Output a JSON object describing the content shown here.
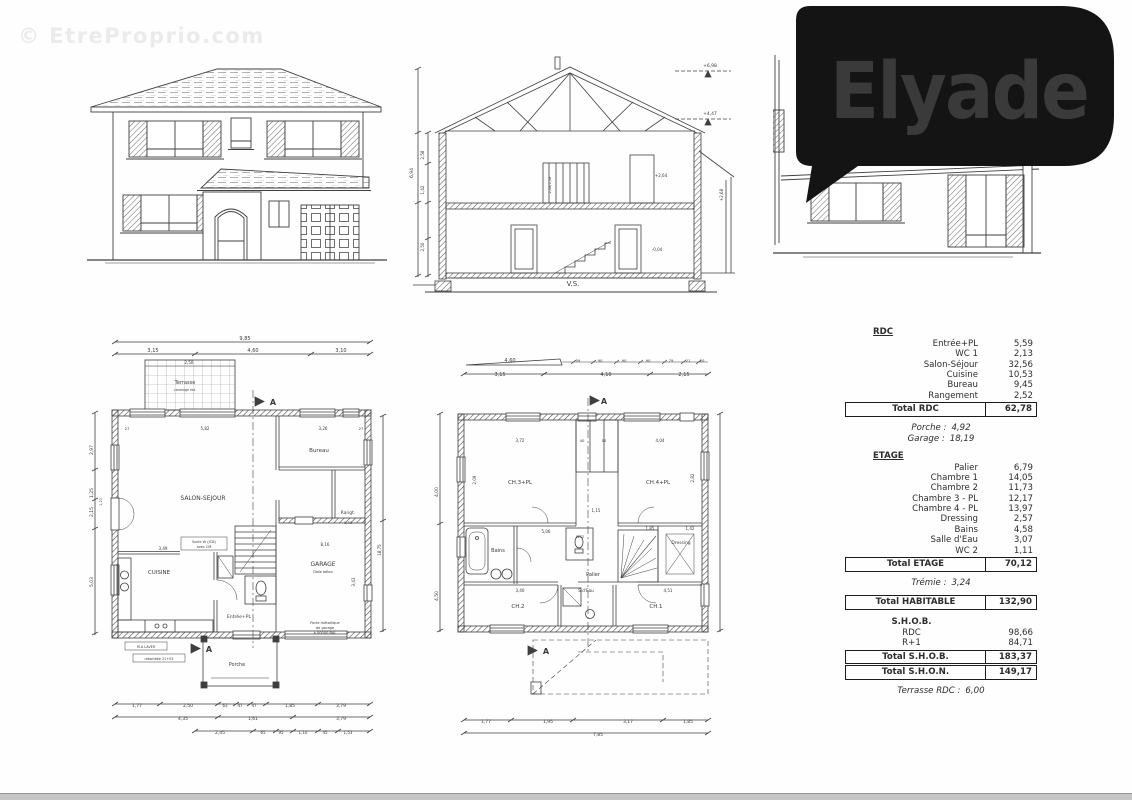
{
  "watermark": {
    "text": "© EtreProprio.com"
  },
  "logo": {
    "text": "Elyade",
    "bg": "#141414",
    "text_color": "#ffffff",
    "underline_from": "#ee1283",
    "underline_to": "#7d2f94"
  },
  "area_table": {
    "rows": [
      {
        "label": "RDC",
        "value": "",
        "style": "header"
      },
      {
        "label": "Entrée+PL",
        "value": "5,59"
      },
      {
        "label": "WC 1",
        "value": "2,13"
      },
      {
        "label": "Salon-Séjour",
        "value": "32,56"
      },
      {
        "label": "Cuisine",
        "value": "10,53"
      },
      {
        "label": "Bureau",
        "value": "9,45"
      },
      {
        "label": "Rangement",
        "value": "2,52"
      },
      {
        "label": "Total RDC",
        "value": "62,78",
        "style": "total"
      },
      {
        "style": "spacer"
      },
      {
        "label": "Porche :",
        "value": "4,92",
        "style": "italic"
      },
      {
        "label": "Garage :",
        "value": "18,19",
        "style": "italic"
      },
      {
        "style": "spacer"
      },
      {
        "label": "ETAGE",
        "value": "",
        "style": "header"
      },
      {
        "label": "Palier",
        "value": "6,79"
      },
      {
        "label": "Chambre 1",
        "value": "14,05"
      },
      {
        "label": "Chambre 2",
        "value": "11,73"
      },
      {
        "label": "Chambre 3 - PL",
        "value": "12,17"
      },
      {
        "label": "Chambre 4 - PL",
        "value": "13,97"
      },
      {
        "label": "Dressing",
        "value": "2,57"
      },
      {
        "label": "Bains",
        "value": "4,58"
      },
      {
        "label": "Salle d'Eau",
        "value": "3,07"
      },
      {
        "label": "WC 2",
        "value": "1,11"
      },
      {
        "label": "Total ETAGE",
        "value": "70,12",
        "style": "total"
      },
      {
        "style": "spacer"
      },
      {
        "label": "Trémie :",
        "value": "3,24",
        "style": "italic"
      },
      {
        "style": "spacer"
      },
      {
        "label": "Total HABITABLE",
        "value": "132,90",
        "style": "total"
      },
      {
        "style": "spacer"
      },
      {
        "label": "S.H.O.B.",
        "value": "",
        "style": "plainhead"
      },
      {
        "label": "RDC",
        "value": "98,66",
        "style": "center"
      },
      {
        "label": "R+1",
        "value": "84,71",
        "style": "center"
      },
      {
        "label": "Total S.H.O.B.",
        "value": "183,37",
        "style": "total"
      },
      {
        "label": "Total S.H.O.N.",
        "value": "149,17",
        "style": "total"
      },
      {
        "style": "spacer"
      },
      {
        "label": "Terrasse RDC :",
        "value": "6,00",
        "style": "italic"
      }
    ]
  },
  "drawings": {
    "section": {
      "labels": [
        {
          "t": "V.S.",
          "x": 168,
          "y": 231,
          "fs": 7
        },
        {
          "t": "+6,98",
          "x": 305,
          "y": 12,
          "fs": 4.5
        },
        {
          "t": "+4,47",
          "x": 305,
          "y": 60,
          "fs": 4.5
        },
        {
          "t": "+2,64",
          "x": 256,
          "y": 122,
          "fs": 4
        },
        {
          "t": "-0,04",
          "x": 252,
          "y": 196,
          "fs": 4
        },
        {
          "t": "+2,68",
          "x": 318,
          "y": 140,
          "fs": 4,
          "rot": 1
        },
        {
          "t": "6,94",
          "x": 8,
          "y": 118,
          "fs": 4.5,
          "rot": 1
        },
        {
          "t": "2,58",
          "x": 19,
          "y": 100,
          "fs": 4,
          "rot": 1
        },
        {
          "t": "1,42",
          "x": 19,
          "y": 135,
          "fs": 4,
          "rot": 1
        },
        {
          "t": "2,50",
          "x": 19,
          "y": 192,
          "fs": 4,
          "rot": 1
        },
        {
          "t": "2,48/2,58",
          "x": 146,
          "y": 130,
          "fs": 3.5,
          "rot": 1
        }
      ]
    },
    "rdc_plan": {
      "labels": [
        {
          "t": "9,85",
          "x": 160,
          "y": 10,
          "fs": 5
        },
        {
          "t": "3,15",
          "x": 68,
          "y": 22,
          "fs": 5
        },
        {
          "t": "4,60",
          "x": 168,
          "y": 22,
          "fs": 5
        },
        {
          "t": "3,10",
          "x": 256,
          "y": 22,
          "fs": 5
        },
        {
          "t": "2,50",
          "x": 104,
          "y": 34,
          "fs": 4
        },
        {
          "t": "Terrasse",
          "x": 100,
          "y": 54,
          "fs": 5
        },
        {
          "t": "carrelage ext.",
          "x": 100,
          "y": 61,
          "fs": 3.2
        },
        {
          "t": "A",
          "x": 188,
          "y": 75,
          "fs": 8,
          "b": 1
        },
        {
          "t": "27",
          "x": 42,
          "y": 100,
          "fs": 3.8
        },
        {
          "t": "5,82",
          "x": 120,
          "y": 100,
          "fs": 4
        },
        {
          "t": "3,26",
          "x": 238,
          "y": 100,
          "fs": 4
        },
        {
          "t": "27",
          "x": 276,
          "y": 100,
          "fs": 3.8
        },
        {
          "t": "SALON-SEJOUR",
          "x": 118,
          "y": 170,
          "fs": 6
        },
        {
          "t": "Bureau",
          "x": 234,
          "y": 122,
          "fs": 5.5
        },
        {
          "t": "Rangt.",
          "x": 263,
          "y": 184,
          "fs": 4.5
        },
        {
          "t": "1,43",
          "x": 263,
          "y": 194,
          "fs": 3.8
        },
        {
          "t": "CUISINE",
          "x": 74,
          "y": 244,
          "fs": 5.5
        },
        {
          "t": "GARAGE",
          "x": 238,
          "y": 236,
          "fs": 6
        },
        {
          "t": "Dalle béton",
          "x": 238,
          "y": 243,
          "fs": 3.4
        },
        {
          "t": "Entrée+PL",
          "x": 154,
          "y": 288,
          "fs": 4.6
        },
        {
          "t": "Socle W (JCB)",
          "x": 119,
          "y": 213,
          "fs": 3.5
        },
        {
          "t": "avec CM",
          "x": 119,
          "y": 218,
          "fs": 3.5
        },
        {
          "t": "3,49",
          "x": 78,
          "y": 220,
          "fs": 4
        },
        {
          "t": "8,16",
          "x": 240,
          "y": 216,
          "fs": 4
        },
        {
          "t": "3,43",
          "x": 270,
          "y": 252,
          "fs": 4,
          "rot": 1
        },
        {
          "t": "18,75",
          "x": 296,
          "y": 220,
          "fs": 4,
          "rot": 1
        },
        {
          "t": "2,97",
          "x": 8,
          "y": 120,
          "fs": 4.5,
          "rot": 1
        },
        {
          "t": "1,25",
          "x": 8,
          "y": 163,
          "fs": 4.5,
          "rot": 1
        },
        {
          "t": "2,15",
          "x": 8,
          "y": 182,
          "fs": 4.5,
          "rot": 1
        },
        {
          "t": "5,03",
          "x": 8,
          "y": 252,
          "fs": 4.5,
          "rot": 1
        },
        {
          "t": "1,20",
          "x": 17,
          "y": 172,
          "fs": 3.4,
          "rot": 1
        },
        {
          "t": "M.A LAVER",
          "x": 61,
          "y": 318,
          "fs": 3.4
        },
        {
          "t": "retombée 21+05",
          "x": 74,
          "y": 330,
          "fs": 3.4
        },
        {
          "t": "Porche",
          "x": 152,
          "y": 336,
          "fs": 4.8
        },
        {
          "t": "A",
          "x": 124,
          "y": 322,
          "fs": 8,
          "b": 1
        },
        {
          "t": "Porte métallique",
          "x": 240,
          "y": 294,
          "fs": 3.6
        },
        {
          "t": "de garage",
          "x": 240,
          "y": 299,
          "fs": 3.6
        },
        {
          "t": "à 00000 RAL",
          "x": 240,
          "y": 304,
          "fs": 3.6
        },
        {
          "t": "1,77",
          "x": 52,
          "y": 377,
          "fs": 4.5
        },
        {
          "t": "2,50",
          "x": 103,
          "y": 377,
          "fs": 4.5
        },
        {
          "t": "63",
          "x": 140,
          "y": 377,
          "fs": 4
        },
        {
          "t": "47",
          "x": 155,
          "y": 377,
          "fs": 4
        },
        {
          "t": "47",
          "x": 169,
          "y": 377,
          "fs": 4
        },
        {
          "t": "1,85",
          "x": 205,
          "y": 377,
          "fs": 4.5
        },
        {
          "t": "3,79",
          "x": 256,
          "y": 377,
          "fs": 4.5
        },
        {
          "t": "4,35",
          "x": 98,
          "y": 390,
          "fs": 4.5
        },
        {
          "t": "1,61",
          "x": 168,
          "y": 390,
          "fs": 4.5
        },
        {
          "t": "3,79",
          "x": 256,
          "y": 390,
          "fs": 4.5
        },
        {
          "t": "2,45",
          "x": 135,
          "y": 404,
          "fs": 4.5
        },
        {
          "t": "65",
          "x": 178,
          "y": 404,
          "fs": 4
        },
        {
          "t": "95",
          "x": 196,
          "y": 404,
          "fs": 4
        },
        {
          "t": "1,10",
          "x": 218,
          "y": 404,
          "fs": 4
        },
        {
          "t": "45",
          "x": 240,
          "y": 404,
          "fs": 4
        },
        {
          "t": "1,53",
          "x": 263,
          "y": 404,
          "fs": 4
        }
      ]
    },
    "etage_plan": {
      "labels": [
        {
          "t": "4,60",
          "x": 82,
          "y": 10,
          "fs": 5
        },
        {
          "t": "59",
          "x": 150,
          "y": 10,
          "fs": 3.8
        },
        {
          "t": "90",
          "x": 172,
          "y": 10,
          "fs": 3.8
        },
        {
          "t": "90",
          "x": 196,
          "y": 10,
          "fs": 3.8
        },
        {
          "t": "90",
          "x": 220,
          "y": 10,
          "fs": 3.8
        },
        {
          "t": "79",
          "x": 243,
          "y": 10,
          "fs": 3.8
        },
        {
          "t": "21",
          "x": 260,
          "y": 10,
          "fs": 3.8
        },
        {
          "t": "20",
          "x": 274,
          "y": 10,
          "fs": 3.8
        },
        {
          "t": "3,15",
          "x": 72,
          "y": 24,
          "fs": 5
        },
        {
          "t": "4,10",
          "x": 178,
          "y": 24,
          "fs": 5
        },
        {
          "t": "2,15",
          "x": 256,
          "y": 24,
          "fs": 5
        },
        {
          "t": "A",
          "x": 176,
          "y": 52,
          "fs": 8,
          "b": 1
        },
        {
          "t": "3,72",
          "x": 92,
          "y": 90,
          "fs": 4
        },
        {
          "t": "40",
          "x": 154,
          "y": 90,
          "fs": 3.8
        },
        {
          "t": "50",
          "x": 176,
          "y": 90,
          "fs": 3.8
        },
        {
          "t": "4,04",
          "x": 232,
          "y": 90,
          "fs": 4
        },
        {
          "t": "CH.3+PL",
          "x": 92,
          "y": 132,
          "fs": 5.5
        },
        {
          "t": "CH.4+PL",
          "x": 230,
          "y": 132,
          "fs": 5.5
        },
        {
          "t": "2,09",
          "x": 48,
          "y": 128,
          "fs": 4,
          "rot": 1
        },
        {
          "t": "2,82",
          "x": 266,
          "y": 126,
          "fs": 4,
          "rot": 1
        },
        {
          "t": "1,15",
          "x": 168,
          "y": 160,
          "fs": 4
        },
        {
          "t": "Bains",
          "x": 70,
          "y": 200,
          "fs": 5
        },
        {
          "t": "WC2",
          "x": 152,
          "y": 186,
          "fs": 3.6
        },
        {
          "t": "Palier",
          "x": 165,
          "y": 224,
          "fs": 5
        },
        {
          "t": "Dressing",
          "x": 253,
          "y": 192,
          "fs": 4.4
        },
        {
          "t": "5,06",
          "x": 118,
          "y": 181,
          "fs": 4
        },
        {
          "t": "1,85",
          "x": 222,
          "y": 178,
          "fs": 4
        },
        {
          "t": "1,42",
          "x": 262,
          "y": 178,
          "fs": 4
        },
        {
          "t": "CH.2",
          "x": 90,
          "y": 256,
          "fs": 5.5
        },
        {
          "t": "S.d'Eau",
          "x": 158,
          "y": 240,
          "fs": 4.2
        },
        {
          "t": "CH.1",
          "x": 228,
          "y": 256,
          "fs": 5.5
        },
        {
          "t": "3,40",
          "x": 92,
          "y": 240,
          "fs": 4
        },
        {
          "t": "4,51",
          "x": 240,
          "y": 240,
          "fs": 4
        },
        {
          "t": "4,00",
          "x": 10,
          "y": 140,
          "fs": 4.5,
          "rot": 1
        },
        {
          "t": "4,50",
          "x": 10,
          "y": 244,
          "fs": 4.5,
          "rot": 1
        },
        {
          "t": "A",
          "x": 118,
          "y": 302,
          "fs": 8,
          "b": 1
        },
        {
          "t": "1,77",
          "x": 58,
          "y": 371,
          "fs": 4.5
        },
        {
          "t": "1,95",
          "x": 120,
          "y": 371,
          "fs": 4.5
        },
        {
          "t": "3,17",
          "x": 200,
          "y": 371,
          "fs": 4.5
        },
        {
          "t": "1,85",
          "x": 260,
          "y": 371,
          "fs": 4.5
        },
        {
          "t": "7,85",
          "x": 170,
          "y": 384,
          "fs": 4.5
        }
      ]
    }
  }
}
